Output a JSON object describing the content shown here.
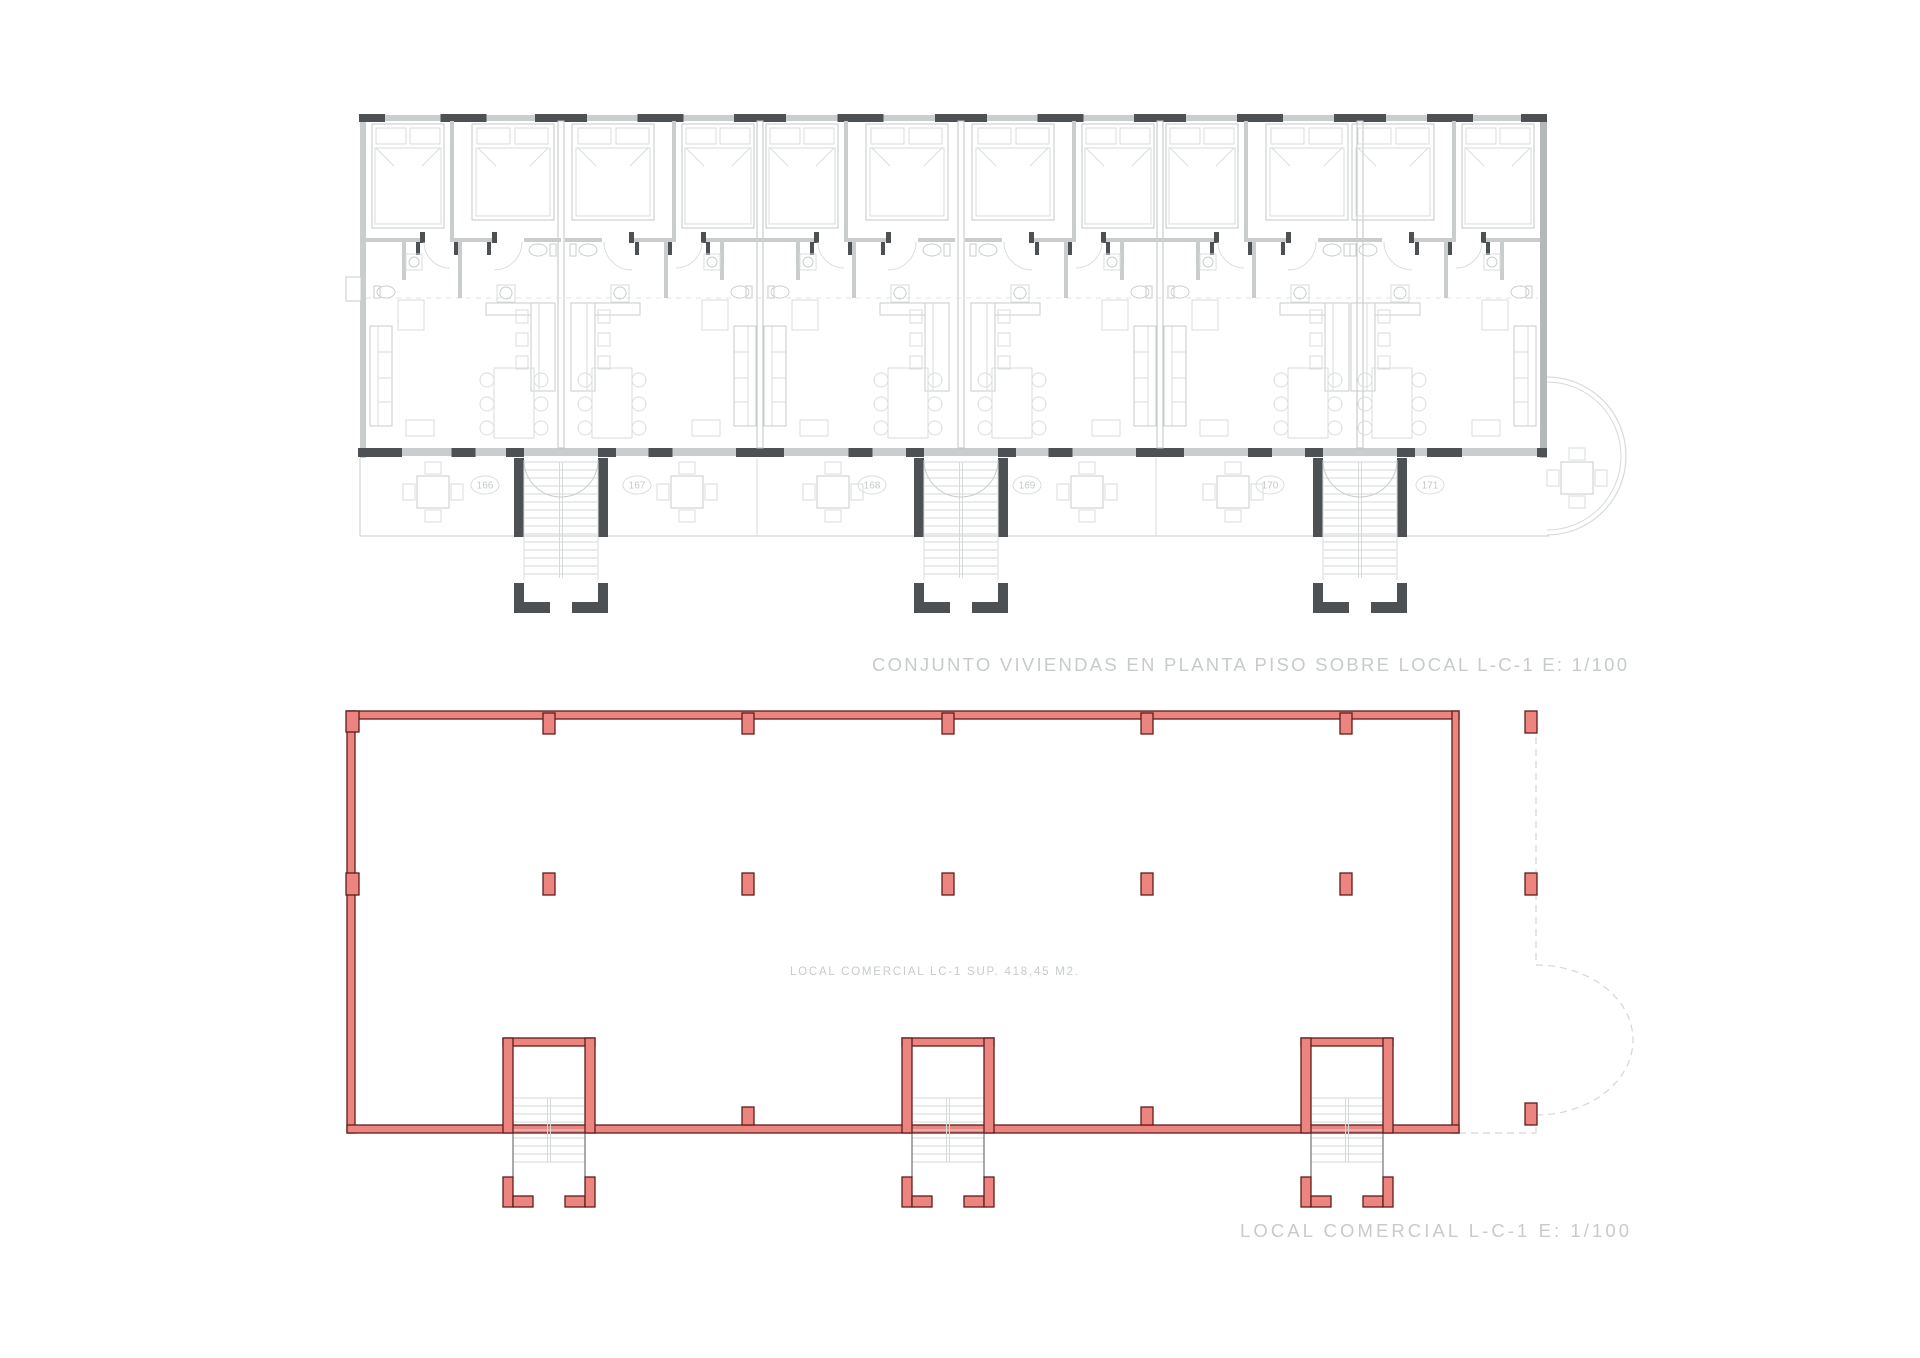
{
  "sheet": {
    "background": "#ffffff"
  },
  "upper_plan": {
    "title": "CONJUNTO VIVIENDAS EN PLANTA PISO SOBRE LOCAL L-C-1  E: 1/100",
    "units": [
      {
        "label": "166"
      },
      {
        "label": "167"
      },
      {
        "label": "168"
      },
      {
        "label": "169"
      },
      {
        "label": "170"
      },
      {
        "label": "171"
      }
    ]
  },
  "lower_plan": {
    "title": "LOCAL COMERCIAL L-C-1 E: 1/100",
    "area_label": "LOCAL COMERCIAL LC-1 SUP. 418,45 M2."
  },
  "colors": {
    "red_fill": "#ec8480",
    "red_stroke": "#5f1d1b",
    "gray_wall": "#c9cdce",
    "gray_faint": "#d9dddd",
    "gray_dark": "#4d5153",
    "gray_mid": "#b4b8b8",
    "tread": "#d6dada",
    "text": "#c7cbcb",
    "dashed": "#d3d7d7"
  }
}
